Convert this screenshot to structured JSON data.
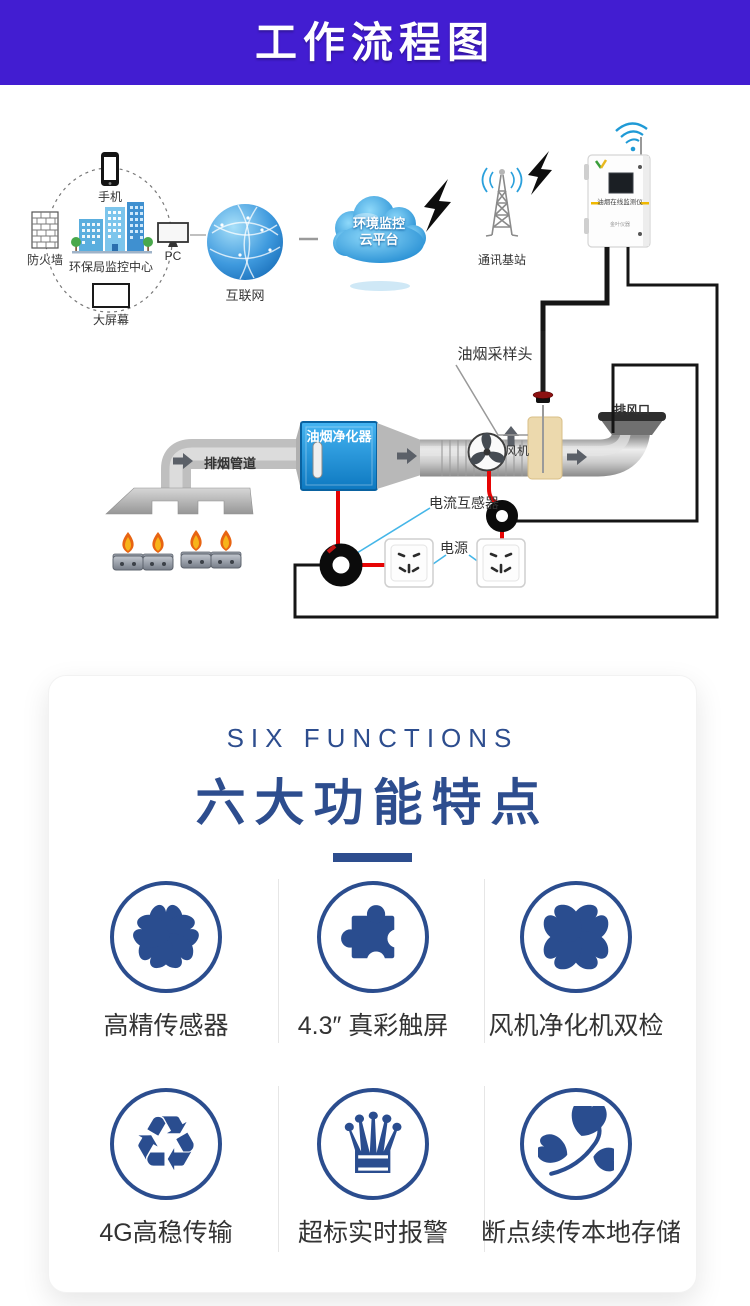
{
  "banner": {
    "title": "工作流程图"
  },
  "diagram": {
    "monitoring_circle": {
      "phone": "手机",
      "firewall": "防火墙",
      "center": "环保局监控中心",
      "pc": "PC",
      "big_screen": "大屏幕"
    },
    "internet": "互联网",
    "cloud": {
      "line1": "环境监控",
      "line2": "云平台"
    },
    "base_station": "通讯基站",
    "device": {
      "title": "油烟在线监测仪",
      "brand": "金叶仪器"
    },
    "sampling_head": "油烟采样头",
    "air_outlet": "排风口",
    "exhaust_duct": "排烟管道",
    "purifier": "油烟净化器",
    "fan": "风机",
    "current_transformer": "电流互感器",
    "power": "电源"
  },
  "functions_section": {
    "subtitle": "SIX FUNCTIONS",
    "title": "六大功能特点",
    "items": [
      {
        "icon": "flower-icon",
        "label": "高精传感器"
      },
      {
        "icon": "puzzle-icon",
        "label": "4.3″ 真彩触屏"
      },
      {
        "icon": "clover-icon",
        "label": "风机净化机双检"
      },
      {
        "icon": "recycle-icon",
        "label": "4G高稳传输",
        "glyph": "♻"
      },
      {
        "icon": "crown-icon",
        "label": "超标实时报警",
        "glyph": "♛"
      },
      {
        "icon": "leaf-icon",
        "label": "断点续传本地存储"
      }
    ]
  },
  "colors": {
    "banner_bg": "#421dd1",
    "accent_blue": "#2d4d8e",
    "purifier_blue": "#1e96dc",
    "wire_red": "#e60404",
    "wire_black": "#151515",
    "pointer_blue": "#45b6e8"
  }
}
